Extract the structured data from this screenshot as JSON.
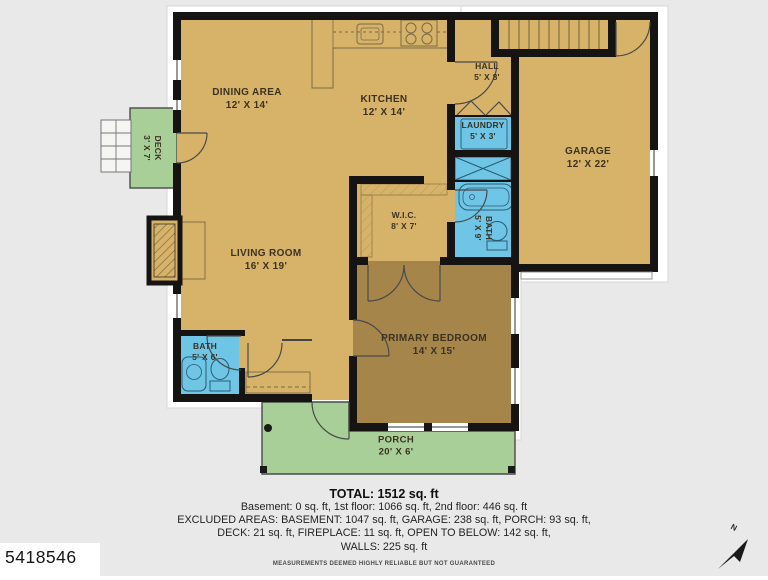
{
  "plan": {
    "rooms": {
      "dining": {
        "name": "DINING AREA",
        "dims": "12' X 14'"
      },
      "kitchen": {
        "name": "KITCHEN",
        "dims": "12' X 14'"
      },
      "hall": {
        "name": "HALL",
        "dims": "5' X 8'"
      },
      "laundry": {
        "name": "LAUNDRY",
        "dims": "5' X 3'"
      },
      "garage": {
        "name": "GARAGE",
        "dims": "12' X 22'"
      },
      "wic": {
        "name": "W.I.C.",
        "dims": "8' X 7'"
      },
      "bath_upper": {
        "name": "BATH",
        "dims": "5' X 9'"
      },
      "living": {
        "name": "LIVING ROOM",
        "dims": "16' X 19'"
      },
      "bath_lower": {
        "name": "BATH",
        "dims": "5' X 6'"
      },
      "primary_bedroom": {
        "name": "PRIMARY BEDROOM",
        "dims": "14' X 15'"
      },
      "deck": {
        "name": "DECK",
        "dims": "3' X 7'"
      },
      "porch": {
        "name": "PORCH",
        "dims": "20' X 6'"
      }
    },
    "colors": {
      "floor_tan": "#d7b369",
      "bedroom_brown": "#a6854a",
      "wet_room_blue": "#6ec5e5",
      "outdoor_green": "#a7cf97",
      "wall_black": "#161412",
      "background_gray": "#e9e9e9"
    }
  },
  "summary": {
    "total": "TOTAL: 1512 sq. ft",
    "line1": "Basement: 0 sq. ft, 1st floor: 1066 sq. ft, 2nd floor: 446 sq. ft",
    "line2": "EXCLUDED AREAS: BASEMENT: 1047 sq. ft, GARAGE: 238 sq. ft, PORCH: 93 sq. ft,",
    "line3": "DECK: 21 sq. ft, FIREPLACE: 11 sq. ft, OPEN TO BELOW: 142 sq. ft,",
    "line4": "WALLS: 225 sq. ft",
    "disclaimer": "MEASUREMENTS DEEMED HIGHLY RELIABLE BUT NOT GUARANTEED"
  },
  "listing_id": "5418546",
  "compass": {
    "label": "N"
  }
}
